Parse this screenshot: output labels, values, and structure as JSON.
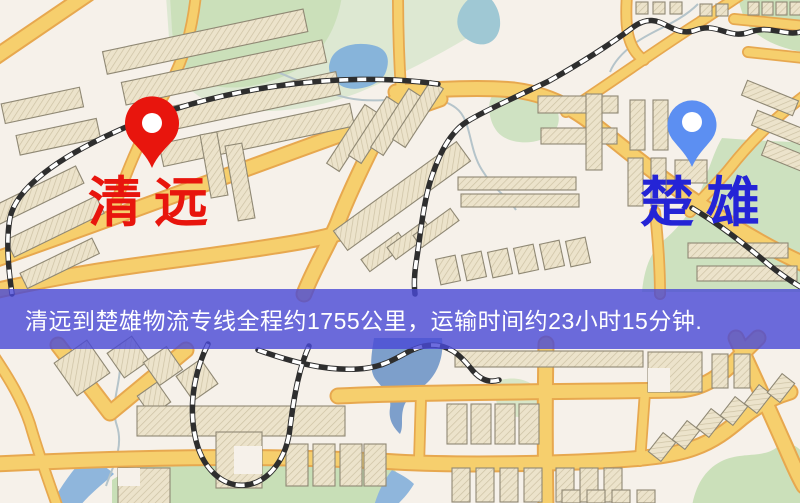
{
  "map": {
    "origin": {
      "label": "清远",
      "pin_icon": "red-map-pin-icon",
      "pin_color": "#e8150d",
      "label_color": "#e8150d"
    },
    "destination": {
      "label": "楚雄",
      "pin_icon": "blue-map-pin-icon",
      "pin_color": "#5c8ff2",
      "label_color": "#2424d6"
    },
    "banner": {
      "text": "清远到楚雄物流专线全程约1755公里，运输时间约23小时15分钟.",
      "bg_color": "rgba(72,72,214,0.80)",
      "text_color": "#ffffff"
    },
    "route": {
      "distance_km": "1755",
      "duration_hours": "23",
      "duration_minutes": "15"
    },
    "theme": {
      "base": "#f6f1ea",
      "road_fill": "#f6cf6d",
      "road_casing": "#e7a84f",
      "park_green": "#cbe0ba",
      "park_green_pale": "#dde8d2",
      "water_blue": "#87b4da",
      "river_blue": "#7d9fcb",
      "building_tan": "#ece3cb",
      "railway_dark": "#2e2e2e"
    }
  }
}
